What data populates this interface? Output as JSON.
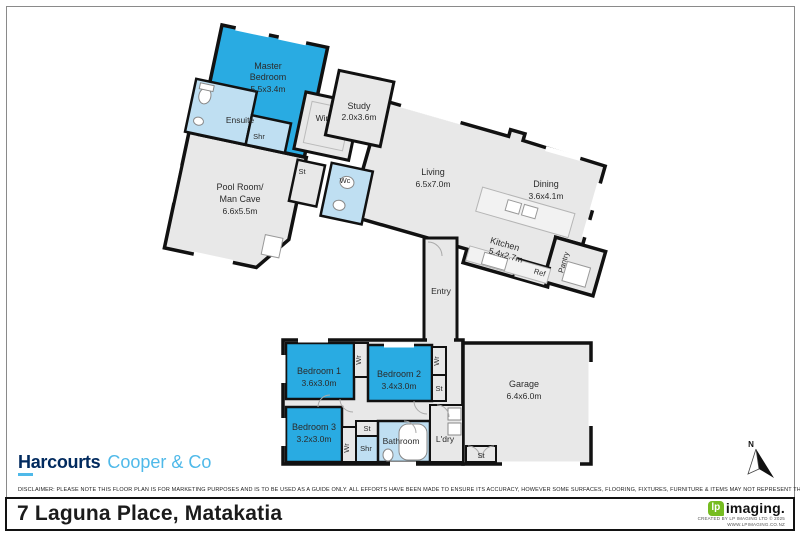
{
  "floorplan": {
    "rooms": {
      "master": {
        "line1": "Master",
        "line2": "Bedroom",
        "dims": "5.5x3.4m"
      },
      "ensuite": {
        "label": "Ensuite"
      },
      "shr_ensuite": {
        "label": "Shr"
      },
      "wir": {
        "label": "Wir"
      },
      "study": {
        "label": "Study",
        "dims": "2.0x3.6m"
      },
      "st_upper": {
        "label": "St"
      },
      "wc": {
        "label": "Wc"
      },
      "poolroom": {
        "line1": "Pool Room/",
        "line2": "Man Cave",
        "dims": "6.6x5.5m"
      },
      "living": {
        "label": "Living",
        "dims": "6.5x7.0m"
      },
      "dining": {
        "label": "Dining",
        "dims": "3.6x4.1m"
      },
      "kitchen": {
        "label": "Kitchen",
        "dims": "5.4x2.7m"
      },
      "ref": {
        "label": "Ref"
      },
      "pantry": {
        "label": "Pantry"
      },
      "entry": {
        "label": "Entry"
      },
      "bedroom1": {
        "label": "Bedroom 1",
        "dims": "3.6x3.0m"
      },
      "bedroom2": {
        "label": "Bedroom 2",
        "dims": "3.4x3.0m"
      },
      "bedroom3": {
        "label": "Bedroom 3",
        "dims": "3.2x3.0m"
      },
      "wr_bed1": {
        "label": "Wr"
      },
      "wr_bed2": {
        "label": "Wr"
      },
      "wr_bed3": {
        "label": "Wr"
      },
      "st_bed2": {
        "label": "St"
      },
      "st_bed3": {
        "label": "St"
      },
      "st_garage": {
        "label": "St"
      },
      "bathroom": {
        "label": "Bathroom"
      },
      "shr_bath": {
        "label": "Shr"
      },
      "ldry": {
        "label": "L'dry"
      },
      "garage": {
        "label": "Garage",
        "dims": "6.4x6.0m"
      }
    },
    "compass": {
      "north_label": "N"
    },
    "colors": {
      "bedroom_fill": "#29abe2",
      "wet_fill": "#bfdff2",
      "room_fill": "#e8e8e8",
      "wall": "#111111"
    }
  },
  "branding": {
    "agency": {
      "name": "Harcourts",
      "suffix": "Cooper & Co"
    },
    "disclaimer": "DISCLAIMER: PLEASE NOTE THIS FLOOR PLAN IS FOR MARKETING PURPOSES AND IS TO BE USED AS A GUIDE ONLY. ALL EFFORTS HAVE BEEN MADE TO ENSURE ITS ACCURACY, HOWEVER SOME SURFACES, FLOORING, FIXTURES, FURNITURE & ITEMS MAY NOT REPRESENT THE ACTUAL PROPERTY.",
    "address": "7 Laguna Place, Matakatia",
    "imaging": {
      "logo_lp": "lp",
      "logo_text": "imaging.",
      "credit_line1": "CREATED BY LP IMAGING LTD © 2025",
      "credit_line2": "WWW.LPIMAGING.CO.NZ"
    }
  }
}
